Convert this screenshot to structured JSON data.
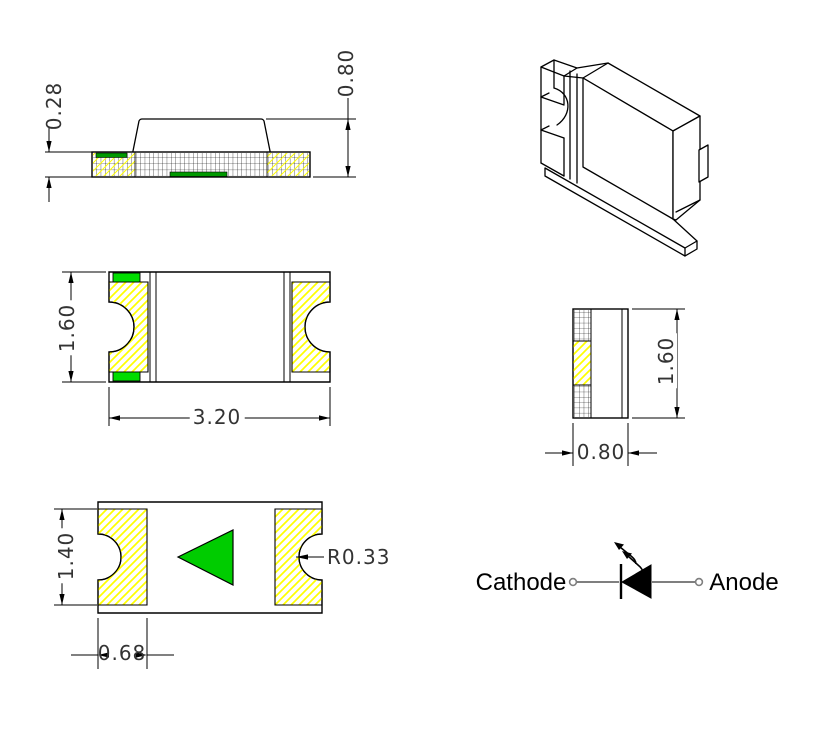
{
  "side_view": {
    "thickness": "0.28",
    "total_height": "0.80"
  },
  "top_view": {
    "body_width": "1.60",
    "body_length": "3.20"
  },
  "end_view": {
    "body_height": "1.60",
    "body_depth": "0.80"
  },
  "bottom_view": {
    "pad_height": "1.40",
    "pad_width": "0.68",
    "notch_radius": "R0.33"
  },
  "symbol": {
    "cathode": "Cathode",
    "anode": "Anode"
  },
  "colors": {
    "line": "#000000",
    "hatch_yellow": "#ffff00",
    "terminal_green": "#00dd00",
    "side_strip_green": "#009900",
    "polarity_green": "#00cc00",
    "wire_gray": "#7f7f7f",
    "dim_text": "#333333"
  }
}
